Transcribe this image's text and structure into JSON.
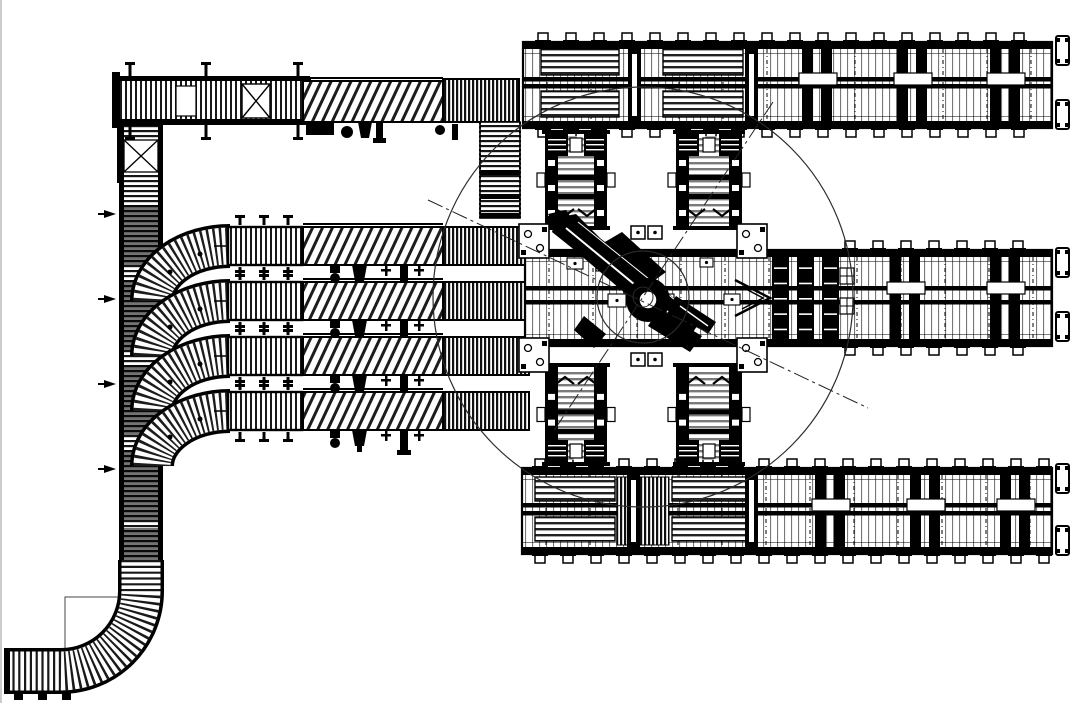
{
  "drawing": {
    "type": "factory-conveyor-layout-plan",
    "background": "#ffffff",
    "ink": "#111111",
    "line_gray": "#333333",
    "description": "CAD plan view of a robotic palletizing cell: central robot with circular work envelope, left infeed roller conveyor with four curved branch lanes, hatched belt conveyors, vertical chain transfer units and three long pallet chain conveyor lines running to the right edge"
  },
  "geometry": {
    "long_rows": [
      {
        "name": "pallet-line-top",
        "x": 523,
        "y": 42,
        "w": 529,
        "h": 86,
        "mid1": 77,
        "mid2": 84,
        "pallets": [
          [
            541,
            49,
            78,
            26
          ],
          [
            541,
            91,
            78,
            26
          ],
          [
            663,
            49,
            80,
            26
          ],
          [
            663,
            91,
            80,
            26
          ]
        ],
        "dividers": [
          628,
          745
        ],
        "stations": [
          817,
          912,
          1005
        ],
        "feet": {
          "from": 543,
          "to": 1045,
          "step": 28
        },
        "bumpers": [
          [
            1056,
            36
          ],
          [
            1056,
            100
          ]
        ],
        "dense": [],
        "shuttle": null
      },
      {
        "name": "pallet-line-middle",
        "x": 525,
        "y": 250,
        "w": 527,
        "h": 96,
        "mid1": 286,
        "mid2": 300,
        "pallets": [],
        "dividers": [],
        "stations": [
          905,
          1005
        ],
        "feet": {
          "from": 850,
          "to": 1045,
          "step": 28
        },
        "bumpers": [
          [
            1056,
            248
          ],
          [
            1056,
            312
          ]
        ],
        "dense": [],
        "shuttle": {
          "x": 772,
          "bars": 3,
          "pitch": 25,
          "barw": 17,
          "blocks": [
            [
              840,
              268,
              14,
              16
            ],
            [
              840,
              298,
              14,
              16
            ]
          ]
        }
      },
      {
        "name": "pallet-line-bottom",
        "x": 522,
        "y": 468,
        "w": 530,
        "h": 86,
        "mid1": 503,
        "mid2": 511,
        "pallets": [
          [
            535,
            477,
            80,
            24
          ],
          [
            535,
            517,
            80,
            24
          ],
          [
            672,
            477,
            78,
            24
          ],
          [
            672,
            517,
            78,
            24
          ]
        ],
        "dividers": [
          627,
          745
        ],
        "stations": [
          830,
          925,
          1015
        ],
        "feet": {
          "from": 540,
          "to": 1045,
          "step": 28
        },
        "bumpers": [
          [
            1056,
            464
          ],
          [
            1056,
            526
          ]
        ],
        "dense": [
          [
            617,
            477,
            52,
            68
          ]
        ],
        "shuttle": null
      }
    ],
    "vertical_units": [
      {
        "name": "chain-transfer-up-left",
        "x": 545,
        "w": 62,
        "y": 130,
        "h": 100,
        "motor": "top"
      },
      {
        "name": "chain-transfer-up-right",
        "x": 676,
        "w": 66,
        "y": 130,
        "h": 100,
        "motor": "top"
      },
      {
        "name": "chain-transfer-down-left",
        "x": 545,
        "w": 62,
        "y": 363,
        "h": 103,
        "motor": "bottom"
      },
      {
        "name": "chain-transfer-down-right",
        "x": 676,
        "w": 66,
        "y": 363,
        "h": 103,
        "motor": "bottom"
      }
    ],
    "branch_rows": {
      "centers": [
        246,
        301,
        356,
        411
      ],
      "straight": {
        "x": 228,
        "w": 74,
        "h": 38
      },
      "belt": {
        "x": 303,
        "w": 140,
        "h": 38
      },
      "roller": {
        "x": 443,
        "w": 86,
        "h": 38
      }
    },
    "top_module": {
      "beltY": 81,
      "beltH": 41,
      "rollerLeft": [
        118,
        78,
        192,
        46
      ],
      "rollerRight": [
        443,
        79,
        76,
        43
      ],
      "downRoller": [
        480,
        122,
        40,
        96
      ]
    },
    "left_line": {
      "x": 120,
      "y": 125,
      "w": 42,
      "h": 448,
      "dark": [
        [
          205,
          60
        ],
        [
          280,
          70
        ],
        [
          365,
          70
        ],
        [
          450,
          70
        ],
        [
          528,
          45
        ]
      ],
      "ticks": [
        214,
        299,
        384,
        469
      ]
    },
    "bottom_curve": {
      "path": "M 141 560 L 141 591 A 80 80 0 0 1 61 671 L 8 671",
      "floor_box": [
        65,
        597,
        58,
        58
      ]
    },
    "robot": {
      "cx": 643,
      "cy": 297,
      "envelope_r": 210,
      "base_r": 46,
      "hub_r": 10
    },
    "corner_plates": [
      [
        519,
        224
      ],
      [
        519,
        338
      ],
      [
        737,
        224
      ],
      [
        737,
        338
      ]
    ],
    "plate_pairs": [
      [
        631,
        226
      ],
      [
        648,
        226
      ],
      [
        631,
        353
      ],
      [
        648,
        353
      ]
    ],
    "sensors": [
      [
        567,
        258,
        16,
        11
      ],
      [
        596,
        262,
        13,
        9
      ],
      [
        608,
        294,
        18,
        13
      ],
      [
        658,
        294,
        16,
        13
      ],
      [
        700,
        258,
        13,
        9
      ],
      [
        724,
        294,
        16,
        11
      ]
    ],
    "centerlines": [
      [
        428,
        200,
        868,
        408
      ],
      [
        773,
        102,
        553,
        432
      ]
    ],
    "flow_arrow": {
      "tipX": 770,
      "midY": 298
    }
  }
}
